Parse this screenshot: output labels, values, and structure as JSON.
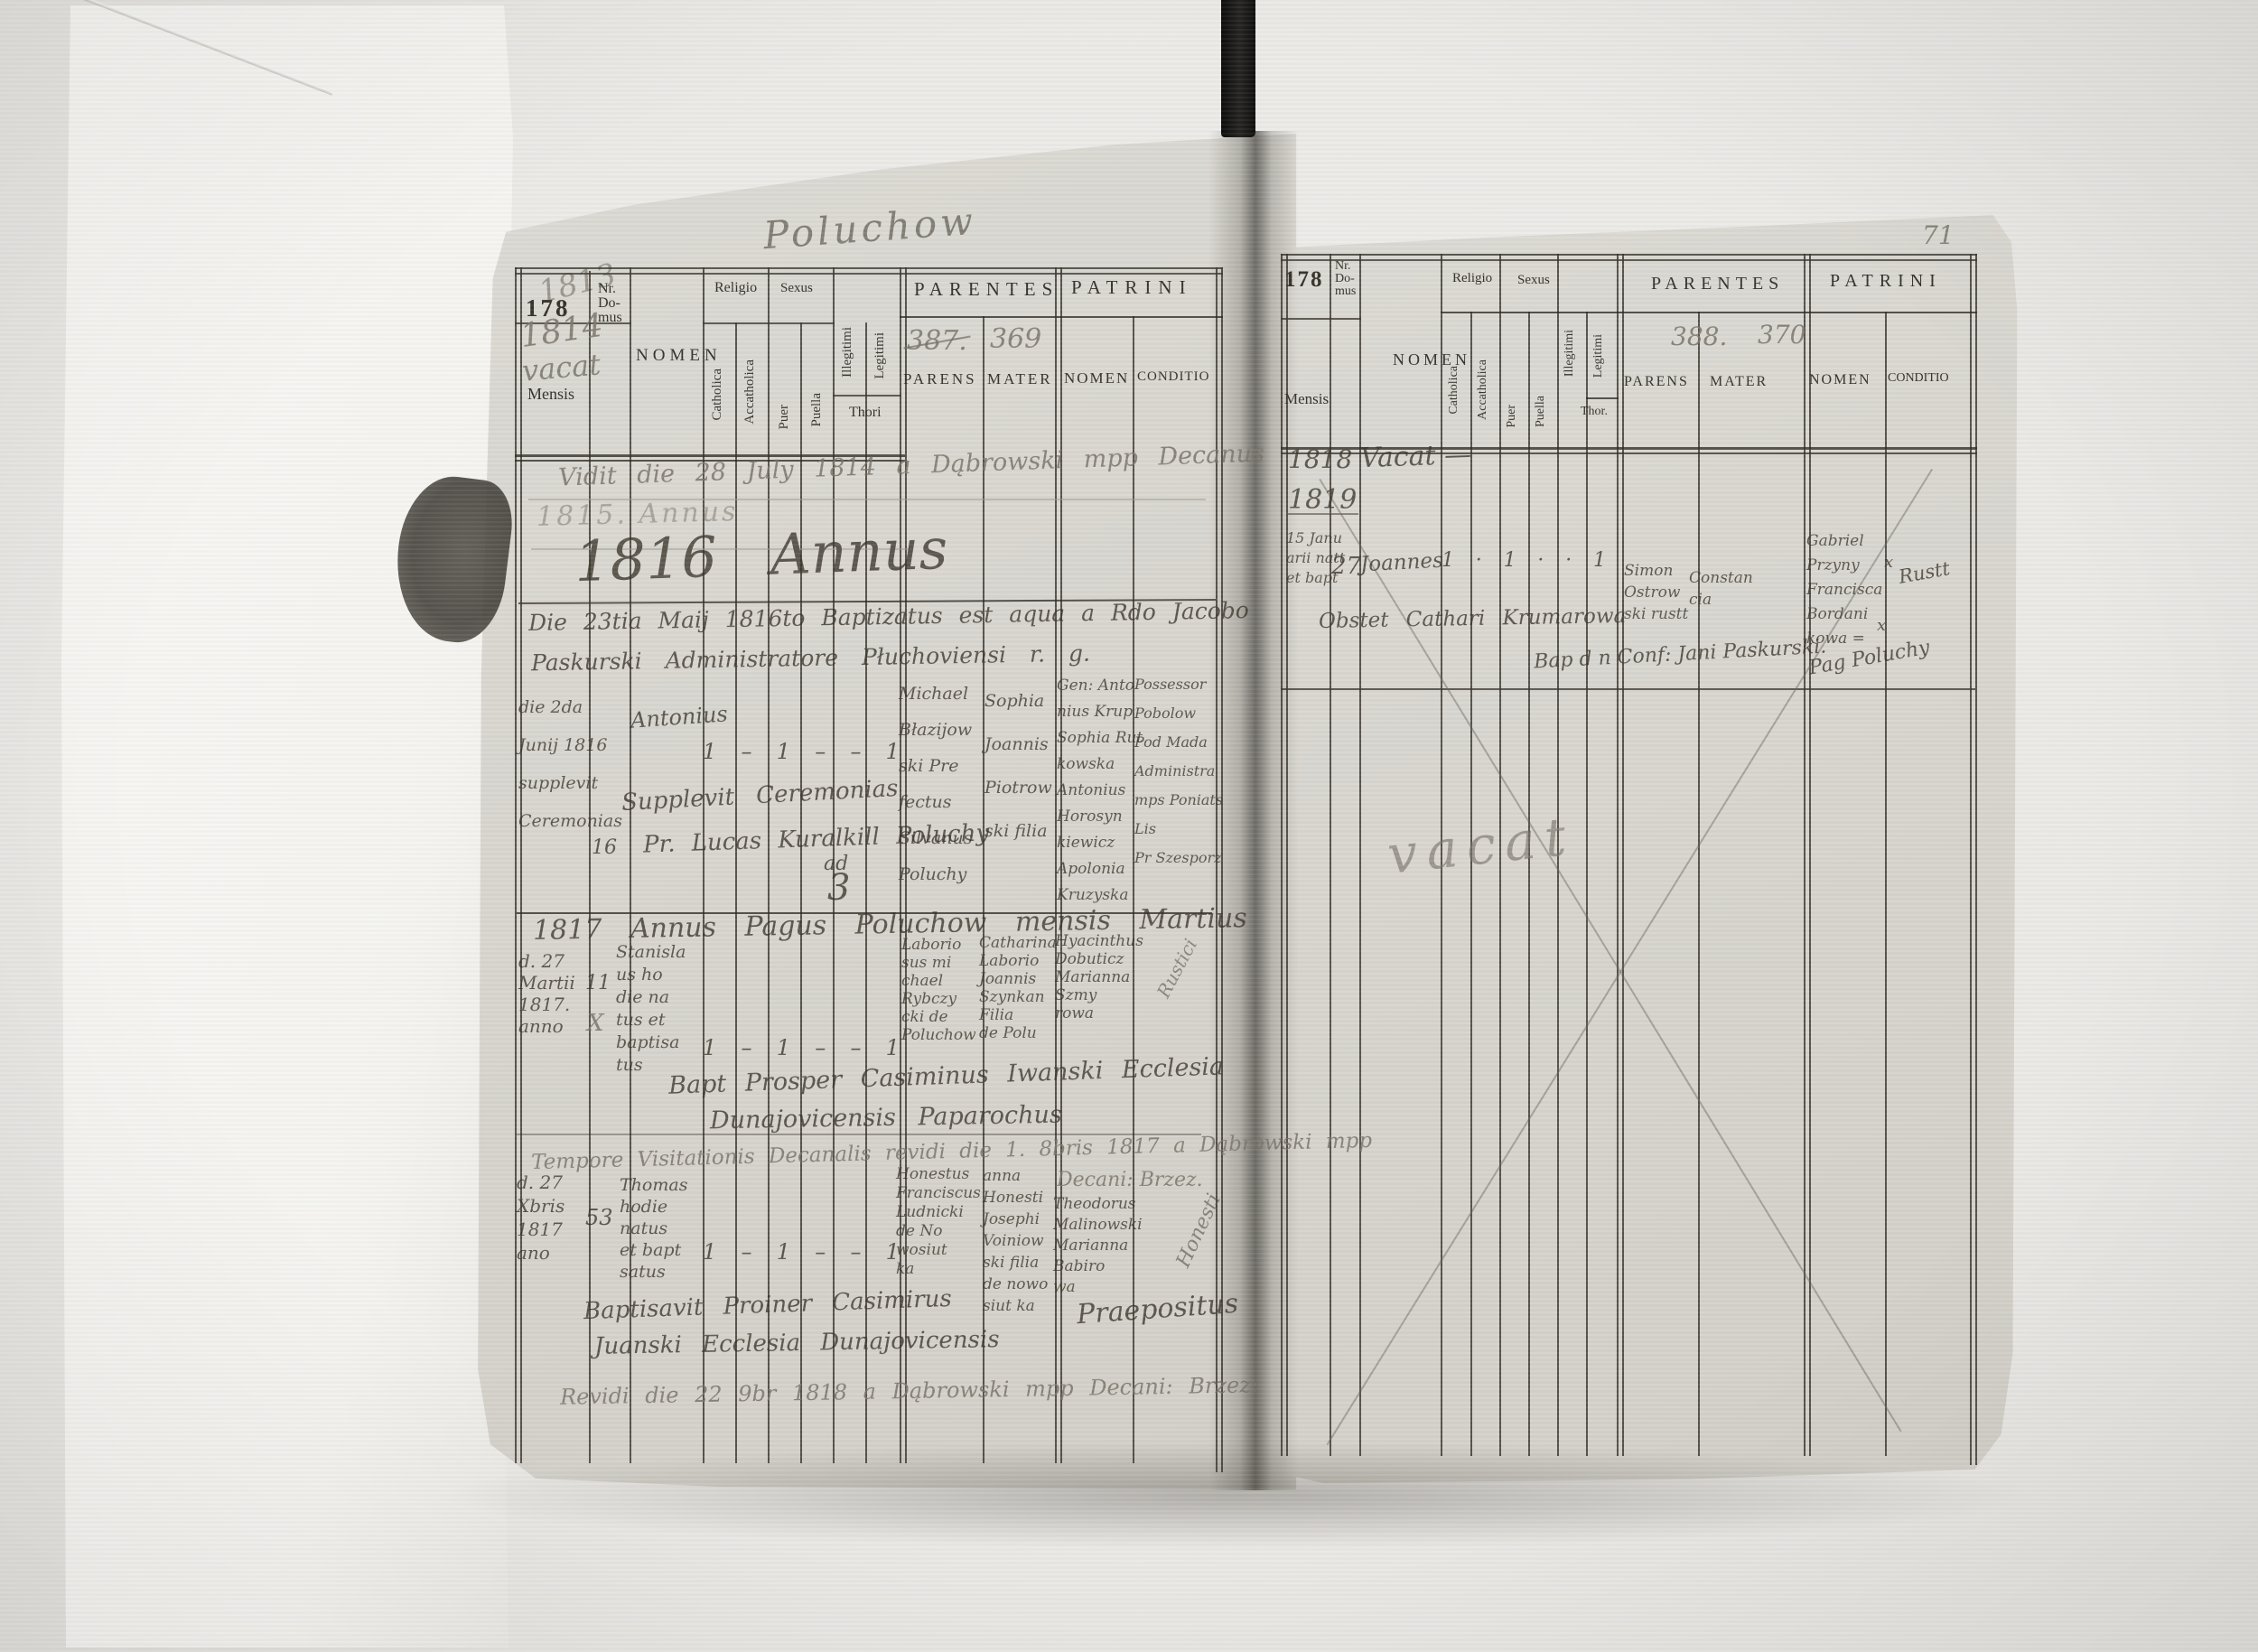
{
  "printed": {
    "page_no": "178",
    "nr_domus": "Nr.\nDo-\nmus",
    "mensis": "Mensis",
    "nomen": "NOMEN",
    "religio": "Religio",
    "catholica": "Catholica",
    "acatholica": "Accatholica",
    "sexus": "Sexus",
    "puer": "Puer",
    "puella": "Puella",
    "illegitimi": "Illegitimi",
    "legitimi": "Legitimi",
    "thori": "Thori",
    "thor": "Thor.",
    "parentes": "PARENTES",
    "parens": "PARENS",
    "mater": "MATER",
    "patrini": "PATRINI",
    "conditio": "CONDITIO"
  },
  "annotations": {
    "village_inscription": "Poluchow",
    "page_corner_pencil": "71"
  },
  "left_page": {
    "year_overwrite": "1813",
    "pencil_year": "1814",
    "pencil_vacat": "vacat",
    "parens_running_no": "387.",
    "mater_running_no": "369",
    "vidit_note": "Vidit die 28 July 1814 a Dąbrowski mpp Decanus",
    "pencil_annus": "1815. Annus",
    "annus_heading": "1816   Annus",
    "entry_1816": {
      "note_line1": "Die 23tia Maij 1816to Baptizatus est aqua a Rdo Jacobo",
      "note_line2": "Paskurski Administratore Płuchoviensi r. g.",
      "mensis": "die 2da\nJunij 1816\nsupplevit\nCeremonias",
      "nr_domus": "16",
      "nomen": "Antonius",
      "ticks": [
        "1",
        "–",
        "1",
        "–",
        "–",
        "1"
      ],
      "parens": "Michael\nBłazijow\nski Pre\nfectus\nSilvanus\nPoluchy",
      "mater": "Sophia\nJoannis\nPiotrow\nski filia",
      "patrini_nomen": "Gen: Anto\nnius Krup\nSophia Rut\nkowska\nAntonius\nHorosyn\nkiewicz\nApolonia\nKruzyska",
      "patrini_conditio": "Possessor\nPobolow\nPod Mada\nAdministra\nmps Poniats\nLis\nPr Szesporz",
      "supplevit_line1": "Supplevit Ceremonias",
      "supplevit_line2": "Pr. Lucas Kuralkill Poluchy",
      "supplevit_ad": "ad",
      "supplevit_no": "3"
    },
    "annus_1817_heading": "1817 Annus Pagus Poluchow mensis Martius",
    "entry_1817_march": {
      "mensis": "d. 27\nMartii\n1817.\nanno",
      "nr_domus": "11",
      "nr_mark": "X",
      "nomen": "Stanisla\nus ho\ndie na\ntus et\nbaptisa\ntus",
      "ticks": [
        "1",
        "–",
        "1",
        "–",
        "–",
        "1"
      ],
      "parens": "Laborio\nsus mi\nchael\nRybczy\ncki de\nPoluchow",
      "mater": "Catharina\nLaborio\nJoannis\nSzynkan\nFilia\nde Polu",
      "patrini_nomen": "Hyacinthus\nDobuticz\nMarianna\nSzmy\nrowa",
      "marginal_note": "Rustici",
      "baptisavit_line1": "Bapt Prosper Casiminus Iwanski Ecclesia",
      "baptisavit_line2": "Dunajovicensis Paparochus"
    },
    "visitation_note": "Tempore Visitationis Decanalis revidi die 1. 8bris 1817 a Dąbrowski mpp",
    "visitation_note_tail": "Decani: Brzez.",
    "entry_1817_dec": {
      "mensis": "d. 27\nXbris\n1817\nano",
      "nr_domus": "53",
      "nomen": "Thomas\nhodie\nnatus\net bapt\nsatus",
      "ticks": [
        "1",
        "–",
        "1",
        "–",
        "–",
        "1"
      ],
      "parens": "Honestus\nFranciscus\nLudnicki\nde No\nwosiut\nka",
      "mater": "anna\nHonesti\nJosephi\nVoiniow\nski filia\nde nowo\nsiut ka",
      "patrini_nomen": "Theodorus\nMalinowski\nMarianna\nBabiro\nwa",
      "marginal_note": "Honesti",
      "praepositus": "Praepositus",
      "baptisavit_line1": "Baptisavit Proiner Casimirus",
      "baptisavit_line2": "Juanski Ecclesia Dunajovicensis"
    },
    "revision_note": "Revidi die 22 9br 1818 a Dąbrowski mpp Decani: Brzez:"
  },
  "right_page": {
    "parens_running_no": "388.",
    "mater_running_no": "370",
    "vacat_year": "1818",
    "vacat_label": "Vacat —",
    "year_1819": "1819",
    "entry_1819": {
      "mensis": "15 Janu\narii natt\net bapt",
      "nr_domus": "27",
      "nomen": "Joannes",
      "ticks": [
        "1",
        "·",
        "1",
        "·",
        "·",
        "1"
      ],
      "parens": "Simon\nOstrow\nski rustt",
      "mater": "Constan\ncia",
      "patrini_nomen": "Gabriel\nPrzyny\nFrancisca\nBordani\nkowa =",
      "patrini_mark1": "x",
      "patrini_mark2": "x",
      "patrini_conditio": "Rustt",
      "obstetrix_note": "Obstet Cathari Krumarowa",
      "baptisavit_note": "Bap d n Conf: Jani Paskurski.",
      "pagus_note": "Pag Poluchy"
    },
    "vacat_big": "vacat"
  }
}
